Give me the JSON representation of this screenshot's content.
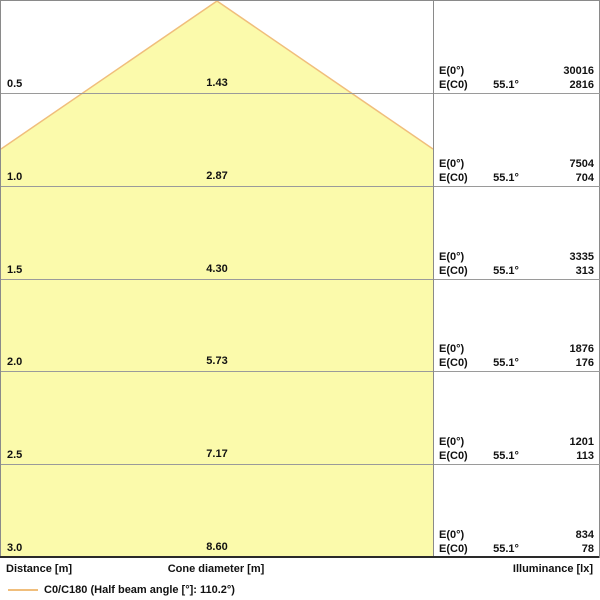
{
  "colors": {
    "cone_fill": "#FBFAAB",
    "cone_edge": "#F0BE7C",
    "grid": "#9a9a9a",
    "axis": "#2a2a2a"
  },
  "rows": [
    {
      "distance": "0.5",
      "diameter": "1.43",
      "e0_label": "E(0°)",
      "e0_value": "30016",
      "ec0_label": "E(C0)",
      "angle": "55.1°",
      "ec0_value": "2816"
    },
    {
      "distance": "1.0",
      "diameter": "2.87",
      "e0_label": "E(0°)",
      "e0_value": "7504",
      "ec0_label": "E(C0)",
      "angle": "55.1°",
      "ec0_value": "704"
    },
    {
      "distance": "1.5",
      "diameter": "4.30",
      "e0_label": "E(0°)",
      "e0_value": "3335",
      "ec0_label": "E(C0)",
      "angle": "55.1°",
      "ec0_value": "313"
    },
    {
      "distance": "2.0",
      "diameter": "5.73",
      "e0_label": "E(0°)",
      "e0_value": "1876",
      "ec0_label": "E(C0)",
      "angle": "55.1°",
      "ec0_value": "176"
    },
    {
      "distance": "2.5",
      "diameter": "7.17",
      "e0_label": "E(0°)",
      "e0_value": "1201",
      "ec0_label": "E(C0)",
      "angle": "55.1°",
      "ec0_value": "113"
    },
    {
      "distance": "3.0",
      "diameter": "8.60",
      "e0_label": "E(0°)",
      "e0_value": "834",
      "ec0_label": "E(C0)",
      "angle": "55.1°",
      "ec0_value": "78"
    }
  ],
  "footer": {
    "distance_axis_label": "Distance [m]",
    "cone_axis_label": "Cone diameter [m]",
    "illuminance_axis_label": "Illuminance [lx]"
  },
  "legend": {
    "label": "C0/C180 (Half beam angle [°]: 110.2°)"
  },
  "chart_data": {
    "type": "table",
    "title": "Luminous cone diagram (light distribution C0/C180)",
    "half_beam_angle_deg": 110.2,
    "half_angle_deg": 55.1,
    "curve": "C0/C180",
    "columns": [
      "Distance [m]",
      "Cone diameter [m]",
      "E(0°) [lx]",
      "E(C0) [lx]",
      "Half angle"
    ],
    "rows": [
      [
        0.5,
        1.43,
        30016,
        2816,
        "55.1°"
      ],
      [
        1.0,
        2.87,
        7504,
        704,
        "55.1°"
      ],
      [
        1.5,
        4.3,
        3335,
        313,
        "55.1°"
      ],
      [
        2.0,
        5.73,
        1876,
        176,
        "55.1°"
      ],
      [
        2.5,
        7.17,
        1201,
        113,
        "55.1°"
      ],
      [
        3.0,
        8.6,
        834,
        78,
        "55.1°"
      ]
    ],
    "axis_ranges": {
      "distance_m": [
        0,
        3.0
      ]
    },
    "legend_position": "bottom-left",
    "grid": true
  }
}
